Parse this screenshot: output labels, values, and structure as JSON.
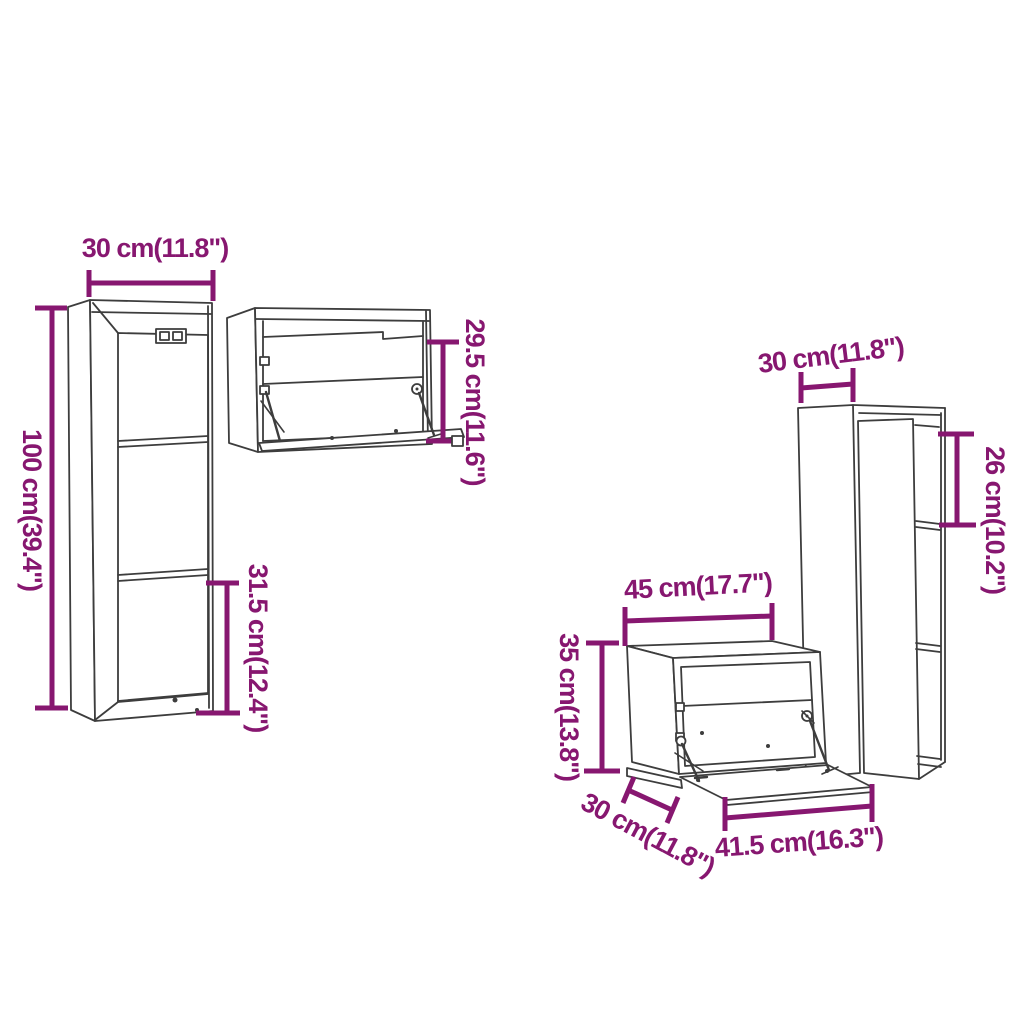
{
  "colors": {
    "dimension_annotation": "#871770",
    "line_art": "#3d3d3d",
    "background": "#ffffff"
  },
  "diagram": {
    "description_type": "furniture-dimension-line-drawing",
    "dimensions": [
      {
        "id": "left-cabinet-width",
        "label": "30 cm(11.8\")",
        "cm": 30,
        "inches": 11.8
      },
      {
        "id": "left-cabinet-height",
        "label": "100 cm(39.4\")",
        "cm": 100,
        "inches": 39.4
      },
      {
        "id": "left-cabinet-compartment-height",
        "label": "31.5 cm(12.4\")",
        "cm": 31.5,
        "inches": 12.4
      },
      {
        "id": "middle-cabinet-height",
        "label": "29.5 cm(11.6\")",
        "cm": 29.5,
        "inches": 11.6
      },
      {
        "id": "right-cabinet-depth",
        "label": "30 cm(11.8\")",
        "cm": 30,
        "inches": 11.8
      },
      {
        "id": "right-cabinet-compartment-height",
        "label": "26 cm(10.2\")",
        "cm": 26,
        "inches": 10.2
      },
      {
        "id": "bottom-cabinet-width",
        "label": "45 cm(17.7\")",
        "cm": 45,
        "inches": 17.7
      },
      {
        "id": "bottom-cabinet-height",
        "label": "35 cm(13.8\")",
        "cm": 35,
        "inches": 13.8
      },
      {
        "id": "bottom-cabinet-depth",
        "label": "30 cm(11.8\")",
        "cm": 30,
        "inches": 11.8
      },
      {
        "id": "bottom-cabinet-flap-width",
        "label": "41.5 cm(16.3\")",
        "cm": 41.5,
        "inches": 16.3
      }
    ]
  }
}
